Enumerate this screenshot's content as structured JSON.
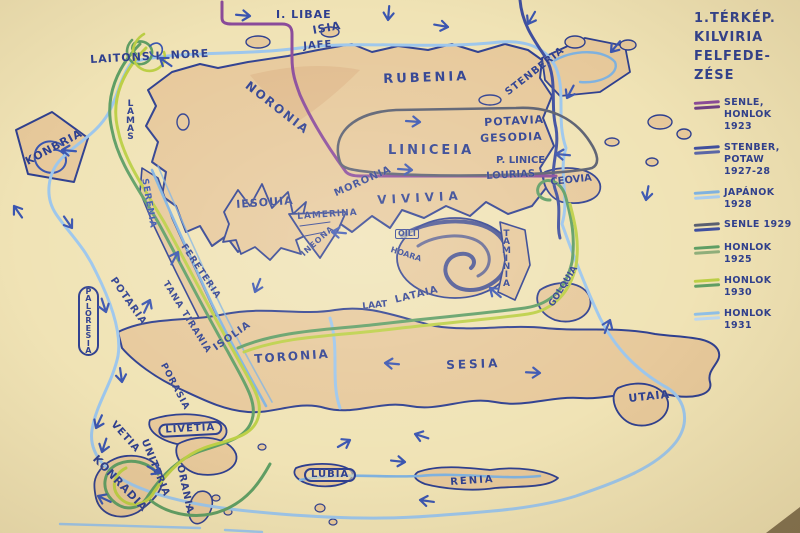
{
  "legend": {
    "title": "1.TÉRKÉP.\nKILVIRIA\nFELFEDE-\nZÉSE",
    "entries": [
      {
        "id": "senle-honlok-1923",
        "label": "SENLE,\nHONLOK 1923",
        "colors": [
          "#8a4a9a",
          "#6d3c86"
        ]
      },
      {
        "id": "stenber-potaw-1927-28",
        "label": "STENBER,\nPOTAW\n1927-28",
        "colors": [
          "#3f4f9f",
          "#5a66a8"
        ]
      },
      {
        "id": "japanok-1928",
        "label": "JAPÁNOK\n1928",
        "colors": [
          "#7fb2e0",
          "#a9cdf0"
        ]
      },
      {
        "id": "senle-1929",
        "label": "SENLE 1929",
        "colors": [
          "#5a5f70",
          "#3f4f9f"
        ]
      },
      {
        "id": "honlok-1925",
        "label": "HONLOK 1925",
        "colors": [
          "#5f9e64",
          "#8fae7a"
        ]
      },
      {
        "id": "honlok-1930",
        "label": "HONLOK 1930",
        "colors": [
          "#bccf45",
          "#5f9e64"
        ]
      },
      {
        "id": "honlok-1931",
        "label": "HONLOK 1931",
        "colors": [
          "#8fc0e8",
          "#bcd8f2"
        ]
      }
    ]
  },
  "map": {
    "paper": "#f0e3b5",
    "land": "#e7c99b",
    "land_dark": "#ddb183",
    "ink": "#2e3f8f",
    "route_colors": {
      "purple": "#8a4a9a",
      "navy": "#3f4f9f",
      "lightblue": "#7fb2e0",
      "sky": "#9cc6ec",
      "dark": "#5a5f70",
      "teal": "#5f9e64",
      "yellowgreen": "#bccf45"
    },
    "labels": [
      {
        "id": "laitons-i-nore",
        "text": "LAITONS I. NORE",
        "x": 90,
        "y": 55,
        "size": 11,
        "rot": -3,
        "ls": 1,
        "mode": "h"
      },
      {
        "id": "i-libae",
        "text": "I. LIBAE",
        "x": 276,
        "y": 10,
        "size": 11,
        "rot": 0,
        "ls": 1,
        "mode": "h"
      },
      {
        "id": "isia",
        "text": "ISIA",
        "x": 312,
        "y": 26,
        "size": 11,
        "rot": -10,
        "ls": 1,
        "mode": "h"
      },
      {
        "id": "jafe",
        "text": "JAFE",
        "x": 303,
        "y": 42,
        "size": 10,
        "rot": -4,
        "ls": 1,
        "mode": "h"
      },
      {
        "id": "noronia",
        "text": "NORONIA",
        "x": 250,
        "y": 80,
        "size": 12,
        "rot": 38,
        "ls": 2,
        "mode": "h"
      },
      {
        "id": "rubenia",
        "text": "RUBENIA",
        "x": 383,
        "y": 74,
        "size": 13,
        "rot": -2,
        "ls": 3,
        "mode": "h"
      },
      {
        "id": "stenberia",
        "text": "STENBERIA",
        "x": 504,
        "y": 90,
        "size": 10,
        "rot": -38,
        "ls": 1,
        "mode": "h"
      },
      {
        "id": "konbria",
        "text": "KONBRIA",
        "x": 24,
        "y": 158,
        "size": 11,
        "rot": -28,
        "ls": 1,
        "mode": "h"
      },
      {
        "id": "lamas",
        "text": "LAMAS",
        "x": 126,
        "y": 100,
        "size": 9,
        "rot": 0,
        "ls": 0,
        "mode": "v"
      },
      {
        "id": "serenia",
        "text": "SERENIA",
        "x": 148,
        "y": 178,
        "size": 9,
        "rot": 80,
        "ls": 1,
        "mode": "h",
        "color": "#3a55b0"
      },
      {
        "id": "iesouia",
        "text": "IESOUIA",
        "x": 236,
        "y": 200,
        "size": 11,
        "rot": -4,
        "ls": 1,
        "mode": "h"
      },
      {
        "id": "lamerina",
        "text": "LAMERINA",
        "x": 297,
        "y": 213,
        "size": 9,
        "rot": -4,
        "ls": 1,
        "mode": "h"
      },
      {
        "id": "ineona",
        "text": "INEONA",
        "x": 300,
        "y": 252,
        "size": 8,
        "rot": -42,
        "ls": 1,
        "mode": "h"
      },
      {
        "id": "fereteria",
        "text": "FERETERIA",
        "x": 186,
        "y": 243,
        "size": 9,
        "rot": 56,
        "ls": 1,
        "mode": "h"
      },
      {
        "id": "tana-tirania",
        "text": "TANA TIRANIA",
        "x": 168,
        "y": 280,
        "size": 9,
        "rot": 58,
        "ls": 1,
        "mode": "h"
      },
      {
        "id": "moronia",
        "text": "MORONIA",
        "x": 333,
        "y": 190,
        "size": 10,
        "rot": -24,
        "ls": 1,
        "mode": "h"
      },
      {
        "id": "liniceia",
        "text": "LINICEIA",
        "x": 388,
        "y": 145,
        "size": 13,
        "rot": 0,
        "ls": 3,
        "mode": "h"
      },
      {
        "id": "vivivia",
        "text": "VIVIVIA",
        "x": 377,
        "y": 195,
        "size": 12,
        "rot": -3,
        "ls": 5,
        "mode": "h"
      },
      {
        "id": "potavia",
        "text": "POTAVIA",
        "x": 484,
        "y": 118,
        "size": 11,
        "rot": -3,
        "ls": 1,
        "mode": "h"
      },
      {
        "id": "gesodia",
        "text": "GESODIA",
        "x": 480,
        "y": 134,
        "size": 11,
        "rot": -2,
        "ls": 1,
        "mode": "h"
      },
      {
        "id": "p-linice",
        "text": "P. LINICE",
        "x": 496,
        "y": 156,
        "size": 10,
        "rot": 0,
        "ls": 0,
        "mode": "h"
      },
      {
        "id": "lourias",
        "text": "LOURIAS",
        "x": 486,
        "y": 172,
        "size": 10,
        "rot": -3,
        "ls": 0,
        "mode": "h"
      },
      {
        "id": "ceovia",
        "text": "CEOVIA",
        "x": 550,
        "y": 178,
        "size": 10,
        "rot": -6,
        "ls": 0,
        "mode": "h"
      },
      {
        "id": "oili",
        "text": "OILI",
        "x": 395,
        "y": 229,
        "size": 8,
        "rot": 0,
        "ls": 0,
        "mode": "h",
        "shape": "box"
      },
      {
        "id": "hoara",
        "text": "HOARA",
        "x": 392,
        "y": 246,
        "size": 8,
        "rot": 18,
        "ls": 0,
        "mode": "h"
      },
      {
        "id": "taminia",
        "text": "TAMINIA",
        "x": 502,
        "y": 230,
        "size": 9,
        "rot": 0,
        "ls": 0,
        "mode": "v"
      },
      {
        "id": "laat",
        "text": "LAAT",
        "x": 362,
        "y": 303,
        "size": 9,
        "rot": -6,
        "ls": 0,
        "mode": "h"
      },
      {
        "id": "lataia",
        "text": "LATAIA",
        "x": 394,
        "y": 296,
        "size": 10,
        "rot": -14,
        "ls": 1,
        "mode": "h"
      },
      {
        "id": "golquia",
        "text": "GOLQUIA",
        "x": 548,
        "y": 304,
        "size": 9,
        "rot": -58,
        "ls": 0,
        "mode": "h"
      },
      {
        "id": "sesia",
        "text": "SESIA",
        "x": 446,
        "y": 360,
        "size": 12,
        "rot": -2,
        "ls": 3,
        "mode": "h"
      },
      {
        "id": "toronia",
        "text": "TORONIA",
        "x": 254,
        "y": 354,
        "size": 12,
        "rot": -4,
        "ls": 2,
        "mode": "h"
      },
      {
        "id": "isolia",
        "text": "ISOLIA",
        "x": 212,
        "y": 345,
        "size": 10,
        "rot": -35,
        "ls": 1,
        "mode": "h"
      },
      {
        "id": "potaria",
        "text": "POTARIA",
        "x": 116,
        "y": 276,
        "size": 10,
        "rot": 55,
        "ls": 1,
        "mode": "h"
      },
      {
        "id": "paloresia",
        "text": "PALORESIA",
        "x": 78,
        "y": 286,
        "size": 8,
        "rot": 0,
        "ls": 0,
        "mode": "v",
        "shape": "oval"
      },
      {
        "id": "porasia",
        "text": "PORASIA",
        "x": 166,
        "y": 362,
        "size": 9,
        "rot": 62,
        "ls": 1,
        "mode": "h"
      },
      {
        "id": "livetia",
        "text": "LIVETIA",
        "x": 158,
        "y": 424,
        "size": 10,
        "rot": -3,
        "ls": 1,
        "mode": "h",
        "shape": "oval"
      },
      {
        "id": "vetia",
        "text": "VETIA",
        "x": 116,
        "y": 420,
        "size": 10,
        "rot": 48,
        "ls": 1,
        "mode": "h"
      },
      {
        "id": "uniteria",
        "text": "UNITERIA",
        "x": 148,
        "y": 438,
        "size": 10,
        "rot": 68,
        "ls": 1,
        "mode": "h"
      },
      {
        "id": "konradia",
        "text": "KONRADIA",
        "x": 98,
        "y": 454,
        "size": 11,
        "rot": 46,
        "ls": 1,
        "mode": "h"
      },
      {
        "id": "orania",
        "text": "ORANIA",
        "x": 184,
        "y": 464,
        "size": 10,
        "rot": 78,
        "ls": 1,
        "mode": "h"
      },
      {
        "id": "lubia",
        "text": "LUBIA",
        "x": 304,
        "y": 468,
        "size": 10,
        "rot": 0,
        "ls": 1,
        "mode": "h",
        "shape": "oval"
      },
      {
        "id": "renia",
        "text": "RENIA",
        "x": 450,
        "y": 478,
        "size": 10,
        "rot": -4,
        "ls": 2,
        "mode": "h"
      },
      {
        "id": "utaia",
        "text": "UTAIA",
        "x": 628,
        "y": 394,
        "size": 11,
        "rot": -6,
        "ls": 1,
        "mode": "h"
      }
    ],
    "arrows": [
      {
        "x": 250,
        "y": 16,
        "a": 5
      },
      {
        "x": 388,
        "y": 20,
        "a": 95
      },
      {
        "x": 448,
        "y": 27,
        "a": 10
      },
      {
        "x": 528,
        "y": 24,
        "a": 120
      },
      {
        "x": 611,
        "y": 52,
        "a": 130
      },
      {
        "x": 567,
        "y": 98,
        "a": 118
      },
      {
        "x": 556,
        "y": 154,
        "a": 185
      },
      {
        "x": 420,
        "y": 122,
        "a": 4
      },
      {
        "x": 412,
        "y": 170,
        "a": 4
      },
      {
        "x": 160,
        "y": 58,
        "a": 215
      },
      {
        "x": 14,
        "y": 206,
        "a": 235
      },
      {
        "x": 62,
        "y": 150,
        "a": 185
      },
      {
        "x": 72,
        "y": 228,
        "a": 55
      },
      {
        "x": 106,
        "y": 312,
        "a": 72
      },
      {
        "x": 122,
        "y": 382,
        "a": 82
      },
      {
        "x": 102,
        "y": 452,
        "a": 108
      },
      {
        "x": 178,
        "y": 252,
        "a": -62
      },
      {
        "x": 150,
        "y": 300,
        "a": -65
      },
      {
        "x": 255,
        "y": 292,
        "a": 112
      },
      {
        "x": 332,
        "y": 232,
        "a": 185
      },
      {
        "x": 385,
        "y": 363,
        "a": 185
      },
      {
        "x": 540,
        "y": 373,
        "a": 3
      },
      {
        "x": 415,
        "y": 434,
        "a": 198
      },
      {
        "x": 405,
        "y": 462,
        "a": 6
      },
      {
        "x": 420,
        "y": 500,
        "a": 188
      },
      {
        "x": 96,
        "y": 428,
        "a": 115
      },
      {
        "x": 160,
        "y": 473,
        "a": 28
      },
      {
        "x": 610,
        "y": 320,
        "a": -68
      },
      {
        "x": 646,
        "y": 200,
        "a": 100
      },
      {
        "x": 98,
        "y": 496,
        "a": 205
      },
      {
        "x": 350,
        "y": 440,
        "a": -30
      },
      {
        "x": 490,
        "y": 288,
        "a": 220
      }
    ]
  }
}
